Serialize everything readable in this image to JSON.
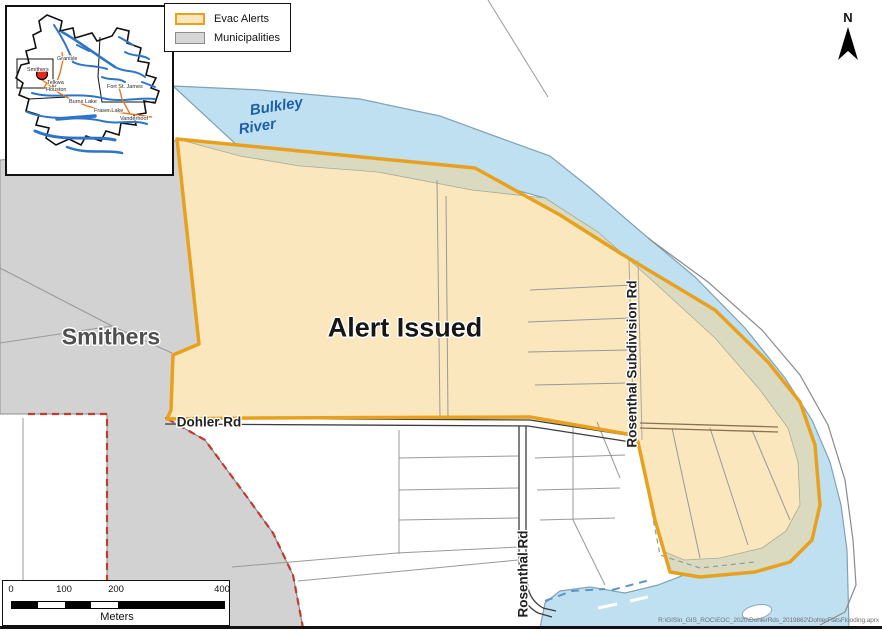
{
  "map_labels": {
    "alert_area": "Alert Issued",
    "municipality": "Smithers",
    "river_line1": "Bulkley",
    "river_line2": "River",
    "road_dohler": "Dohler Rd",
    "road_rosenthal": "Rosenthal Rd",
    "road_rosenthal_subdivision": "Rosenthal Subdivision Rd"
  },
  "legend": {
    "items": [
      {
        "label": "Evac Alerts",
        "fill": "#FBE7BE",
        "border": "#E8A11E"
      },
      {
        "label": "Municipalities",
        "fill": "#D6D6D6",
        "border": "#8C8C8C"
      }
    ]
  },
  "north_arrow": {
    "label": "N"
  },
  "scale_bar": {
    "ticks": [
      "0",
      "100",
      "200",
      "400"
    ],
    "unit": "Meters"
  },
  "inset": {
    "towns": [
      "Smithers",
      "Granisle",
      "Telkwa",
      "Houston",
      "Fort St. James",
      "Burns Lake",
      "Fraser Lake",
      "Vanderhoof"
    ]
  },
  "credit": {
    "path_text": "R:\\GISIn_GIS_ROC\\EOC_2020\\DohlerRds_2019862\\DohlerFlatsFlooding.aprx"
  },
  "colors": {
    "evac_fill": "#FBE7BE",
    "evac_border": "#E8A11E",
    "municipality_fill": "#D2D2D2",
    "river_fill": "#BFE0F1",
    "floodplain_overlap": "#D9DABF",
    "municipal_boundary": "#C23B2E",
    "river_label": "#1F5FA8"
  }
}
